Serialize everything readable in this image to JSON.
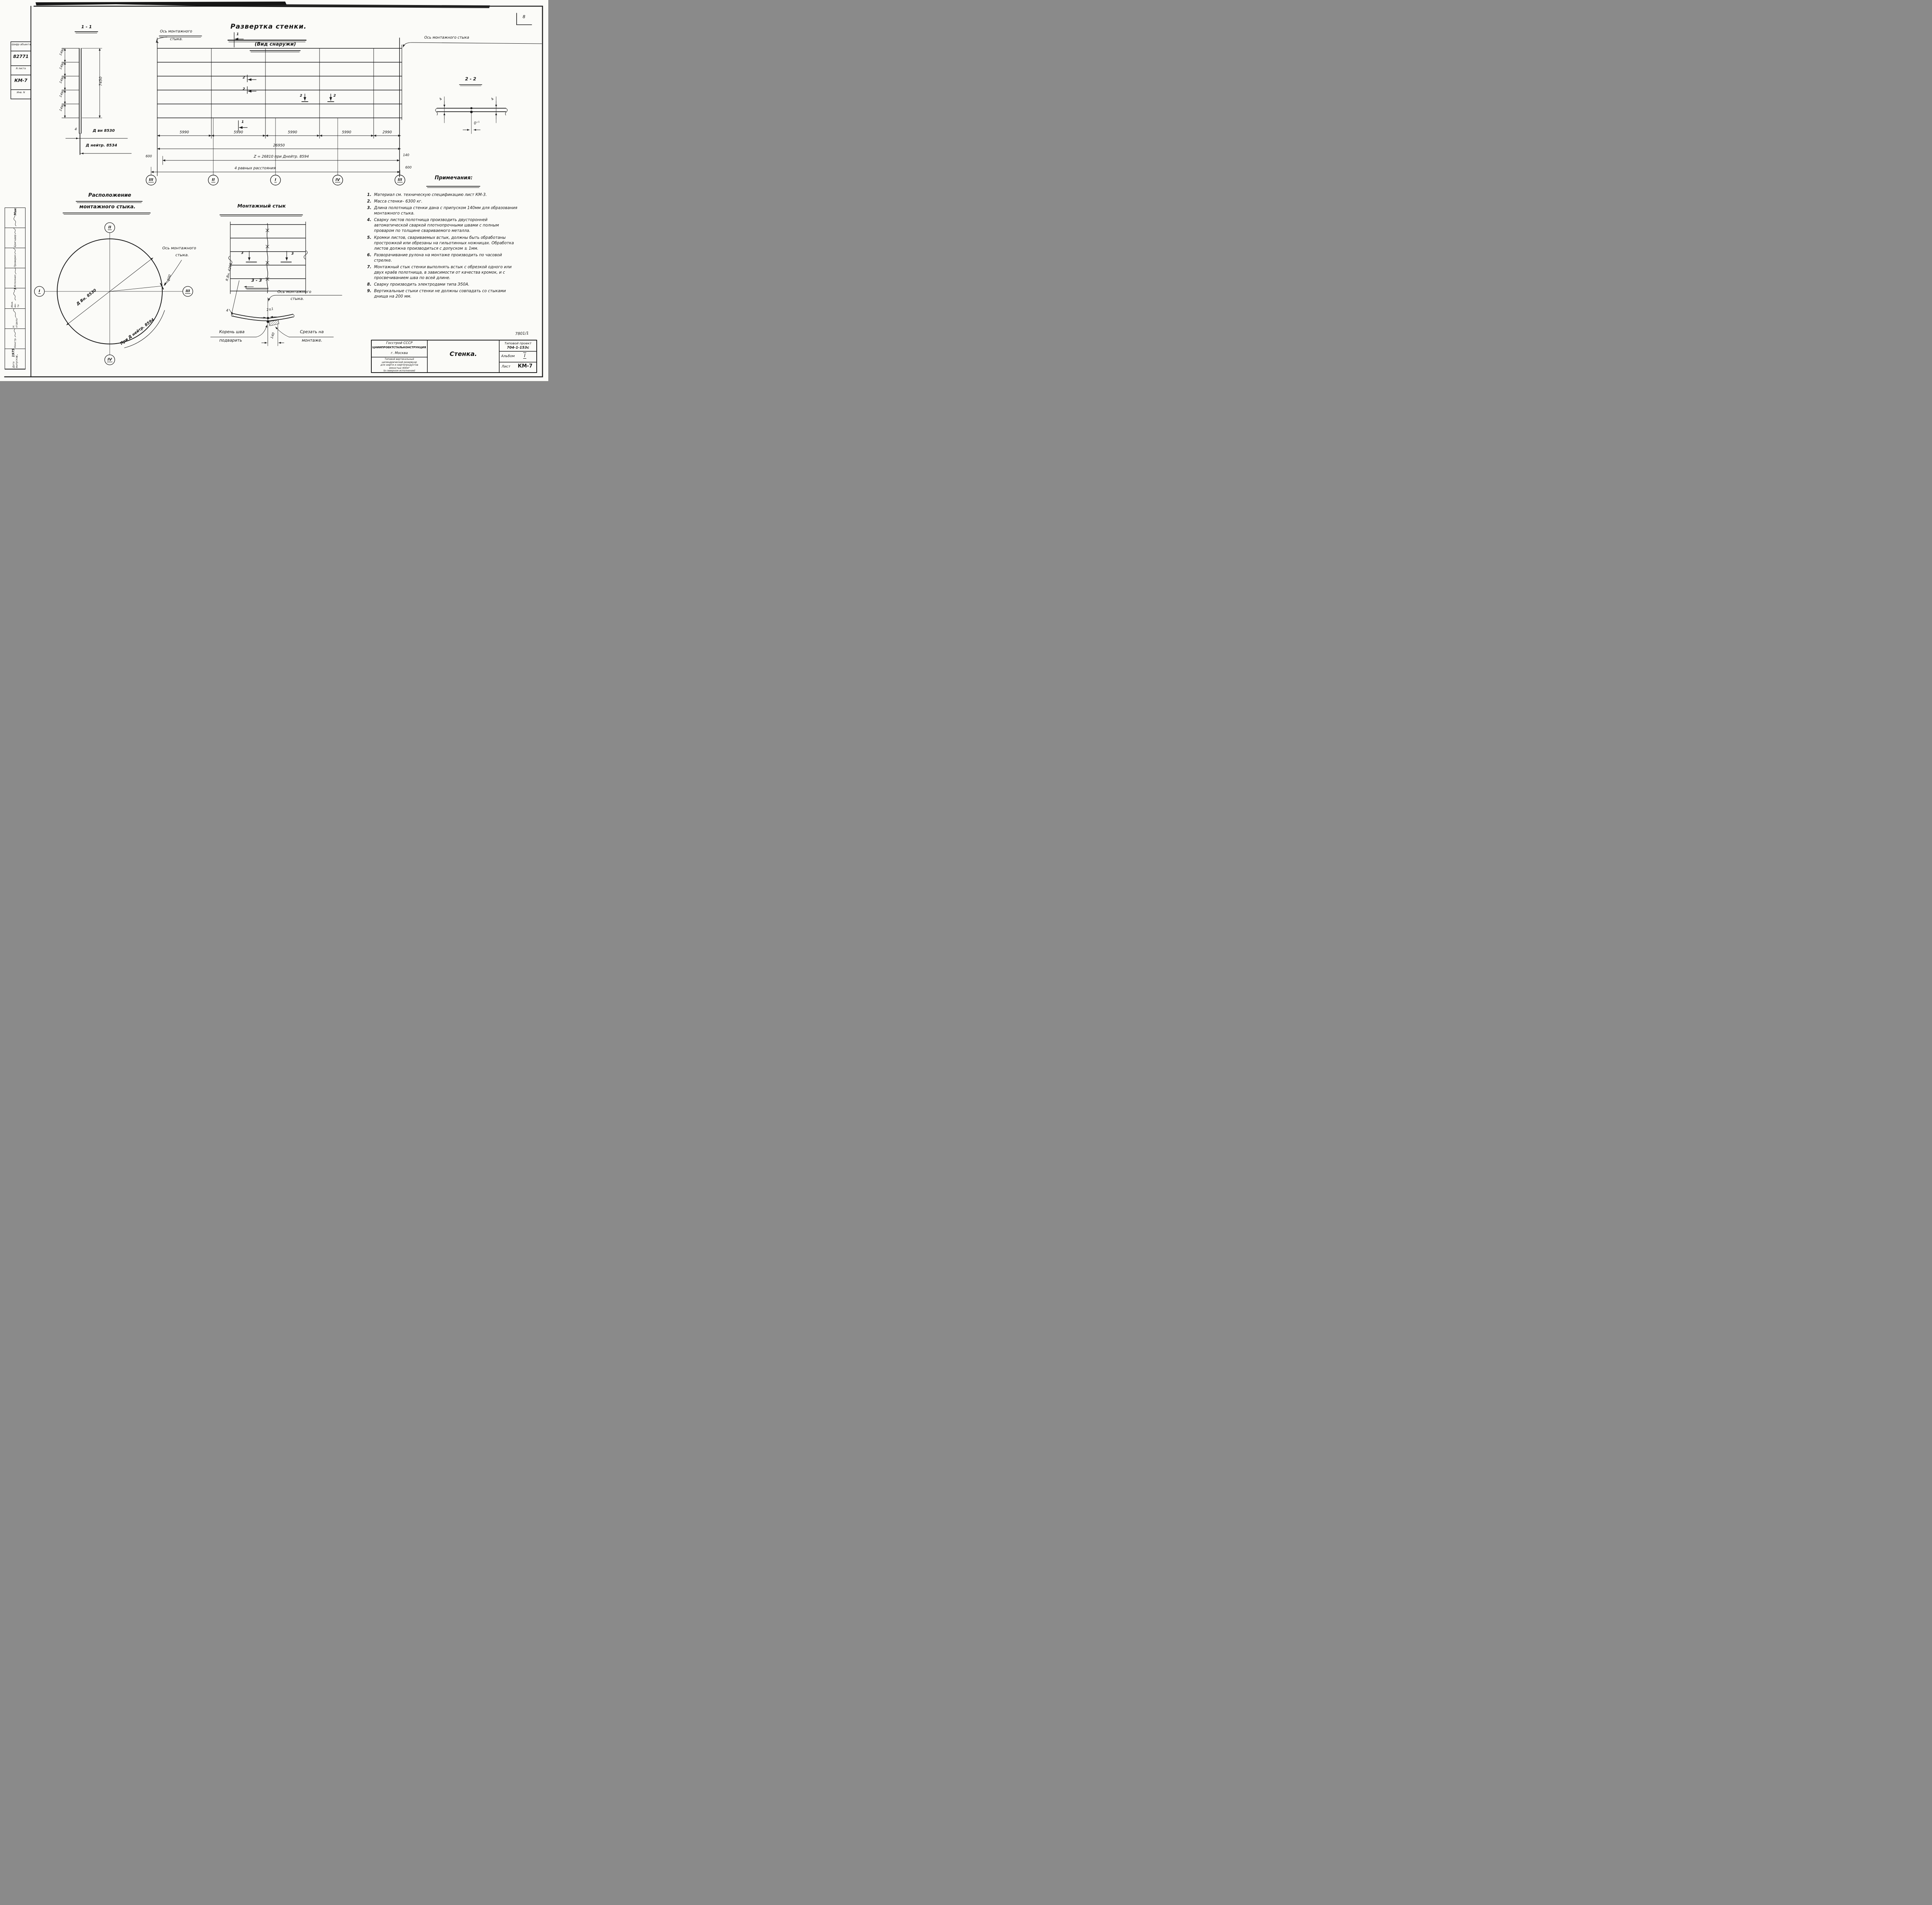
{
  "page": {
    "corner_number": "8",
    "doc_number": "7801/1"
  },
  "top_left_stamp": {
    "rows": [
      "Шифр объекта",
      "82771",
      "N листа",
      "КМ-7",
      "Инв. N"
    ]
  },
  "development": {
    "title": "Развертка стенки.",
    "subtitle": "(Вид снаружи)",
    "seam_axis_left_line1": "Ось монтажного",
    "seam_axis_left_line2": "стыка.",
    "seam_axis_right": "Ось монтажного стыка",
    "section_mark_1": "1",
    "section_mark_2": "2",
    "panel_dims": [
      "5990",
      "5990",
      "5990",
      "5990",
      "2990"
    ],
    "total_dim": "26950",
    "z_dim": "Z = 26810 при Днейтр. 8594",
    "offset_left": "600",
    "allowance_right": "140",
    "offset_right": "600",
    "equal_note": "4 равных расстояния",
    "axis_bubbles": [
      "III",
      "II",
      "I",
      "IV",
      "III"
    ]
  },
  "section_1_1": {
    "title": "1 - 1",
    "course_dims": [
      "1490",
      "1490",
      "1490",
      "1490",
      "1490"
    ],
    "height_dim": "7450",
    "thickness": "4",
    "dia_inner": "Д вн 8530",
    "dia_neutral": "Д нейтр. 8534"
  },
  "stik_view": {
    "title": "Монтажный  стык",
    "section_mark": "3"
  },
  "section_3_3": {
    "title": "3 - 3",
    "radius_label": "R.Вн. 4265",
    "axis_line1": "Ось монтажного",
    "axis_line2": "стыка.",
    "gap": "2±1",
    "root_line1": "Корень шва",
    "root_line2": "подварить",
    "cut_line1": "Срезать на",
    "cut_line2": "монтаже.",
    "width_dim": "140",
    "thickness": "4"
  },
  "section_2_2": {
    "title": "2 - 2",
    "thickness_left": "4",
    "thickness_right": "4",
    "gap": "0⁺¹"
  },
  "stik_layout": {
    "title_line1": "Расположение",
    "title_line2": "монтажного  стыка.",
    "axis_top": "II",
    "axis_bottom": "IV",
    "axis_left": "I",
    "axis_right": "III",
    "dia_label": "Д Вн. 8530",
    "arc_label": "При Д нейтр. 8594",
    "offset": "600",
    "seam_line1": "Ось монтажного",
    "seam_line2": "стыка."
  },
  "notes": {
    "title": "Примечания:",
    "items": [
      {
        "n": "1.",
        "t": "Материал см. техническую спецификацию лист КМ-3."
      },
      {
        "n": "2.",
        "t": "Масса стенки– 6300 кг."
      },
      {
        "n": "3.",
        "t": "Длина полотнища стенки дана с припуском 140мм для образования монтажного стыка."
      },
      {
        "n": "4.",
        "t": "Сварку листов полотнища производить двусторонней автоматической сваркой плотнопрочными швами с полным проваром по толщине свариваемого металла."
      },
      {
        "n": "5.",
        "t": "Кромки листов, свариваемых встык, должны быть обработаны прострожкой или обрезаны на гильотинных ножницах. Обработка листов должна производиться с допуском ± 1мм."
      },
      {
        "n": "6.",
        "t": "Разворачивание рулона на монтаже производить по часовой стрелке."
      },
      {
        "n": "7.",
        "t": "Монтажный стык стенки выполнять встык с обрезкой одного или двух краёв полотнища, в зависимости от качества кромок, и с просвечиванием шва по всей длине."
      },
      {
        "n": "8.",
        "t": "Сварку производить электродами типа Э50А."
      },
      {
        "n": "9.",
        "t": "Вертикальные стыки стенки не должны совпадать со стыками днища на 200 мм."
      }
    ]
  },
  "title_block": {
    "org_line1": "Госстрой СССР",
    "org_line2": "ЦНИИПРОЕКТСТАЛЬКОНСТРУКЦИЯ",
    "org_line3": "г. Москва",
    "desc_lines": [
      "Типовой вертикальный",
      "цилиндрический резервуар",
      "для нефти и нефтепродуктов",
      "емкостью 400м³",
      "(в северном исполнении)"
    ],
    "sheet_title": "Стенка.",
    "type_label": "Типовой проект",
    "type_value": "704-1-153с",
    "album_label": "Альбом",
    "album_value": "I",
    "sheet_label": "Лист",
    "sheet_value": "КМ-7"
  },
  "signature_strip": {
    "rows": [
      {
        "role": "",
        "name": "Максимец"
      },
      {
        "role": "Бригадир",
        "name": "Иншаков"
      },
      {
        "role": "Проверил",
        "name": "Иншаков"
      },
      {
        "role": "Исполнил",
        "name": "Федорова"
      },
      {
        "role": "Инж. ин-та",
        "name": "Кузнецов"
      },
      {
        "role": "Н. отдела",
        "name": "Томпина"
      },
      {
        "role": "Констр.",
        "name": "Максимец"
      },
      {
        "role": "Дата выпуска",
        "name": "1975 г."
      }
    ]
  }
}
